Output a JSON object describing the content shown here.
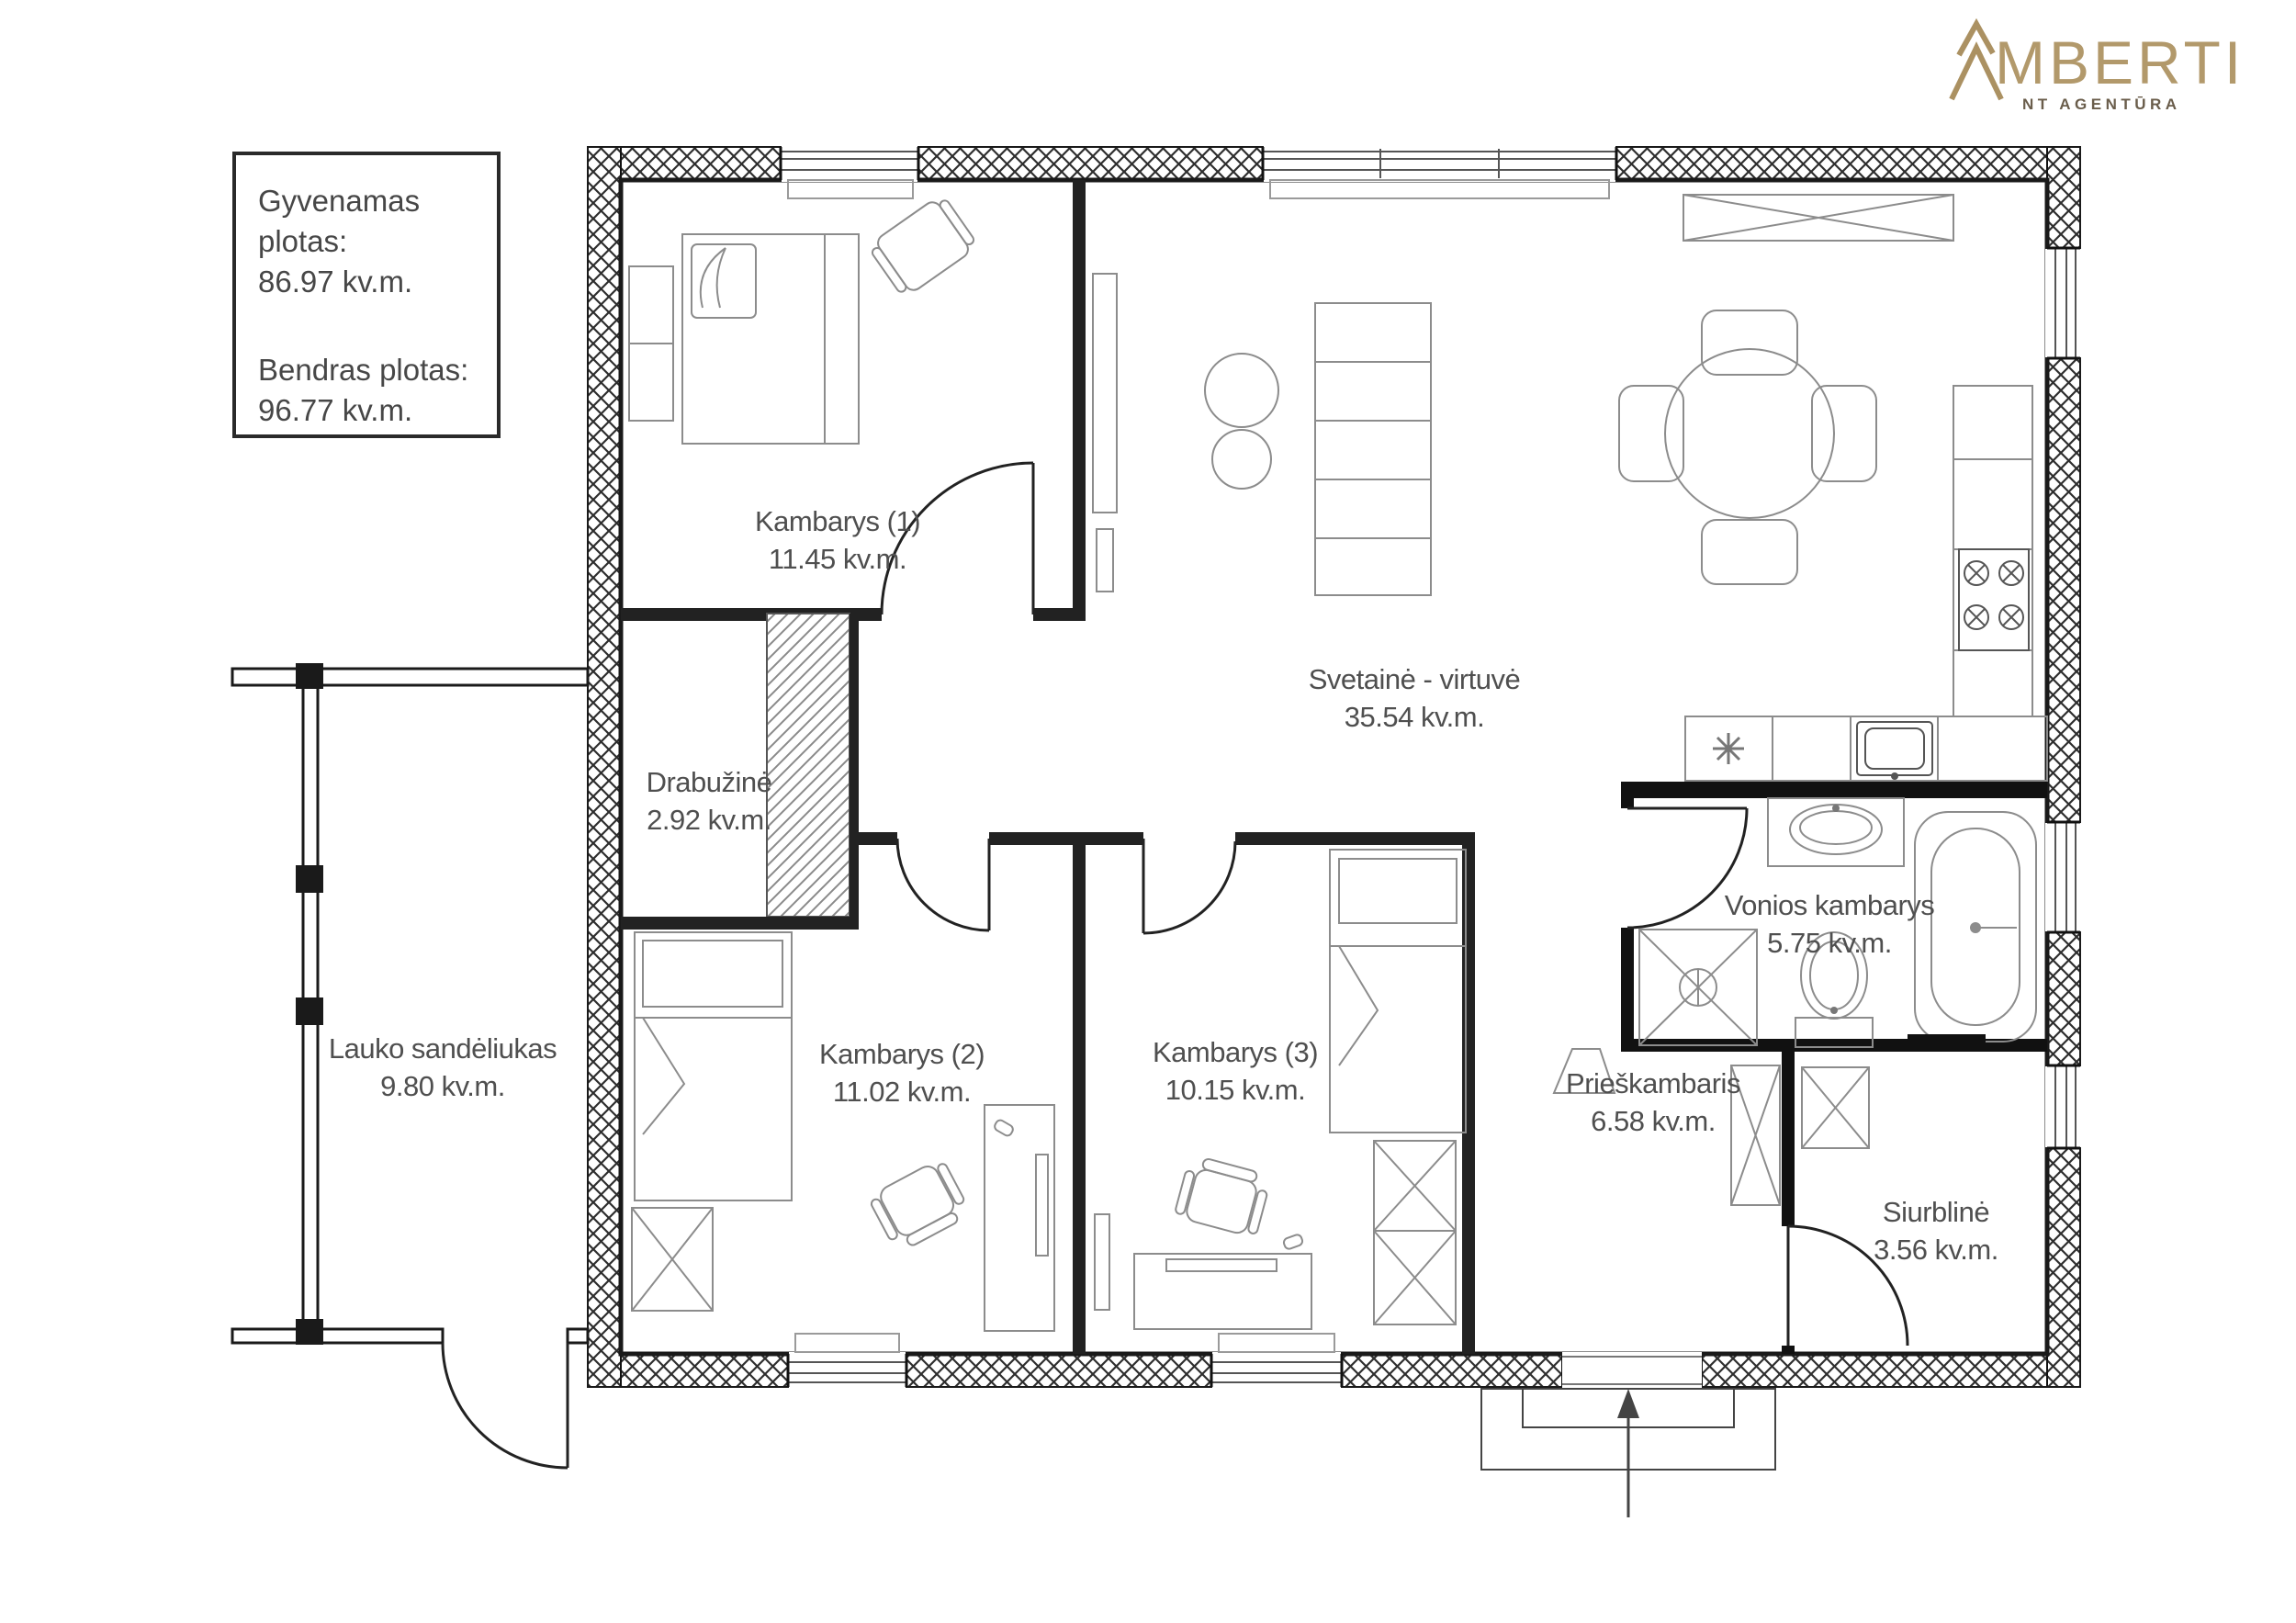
{
  "logo": {
    "name": "AMBERTI",
    "tagline": "NT AGENTŪRA"
  },
  "info_box": {
    "line1_label": "Gyvenamas plotas:",
    "line1_value": "86.97 kv.m.",
    "line2_label": "Bendras plotas:",
    "line2_value": "96.77 kv.m."
  },
  "rooms": [
    {
      "name": "Kambarys (1)",
      "area": "11.45 kv.m."
    },
    {
      "name": "Svetainė - virtuvė",
      "area": "35.54 kv.m."
    },
    {
      "name": "Drabužinė",
      "area": "2.92 kv.m."
    },
    {
      "name": "Lauko sandėliukas",
      "area": "9.80 kv.m."
    },
    {
      "name": "Kambarys (2)",
      "area": "11.02 kv.m."
    },
    {
      "name": "Kambarys (3)",
      "area": "10.15 kv.m."
    },
    {
      "name": "Vonios kambarys",
      "area": "5.75 kv.m."
    },
    {
      "name": "Prieškambaris",
      "area": "6.58 kv.m."
    },
    {
      "name": "Siurblinė",
      "area": "3.56 kv.m."
    }
  ],
  "symbols": {
    "entrance_arrow": "arrow-up",
    "stove_burner": "circle-with-x",
    "wardrobe": "rect-with-x",
    "kitchen_fixture": "asterisk"
  },
  "colors": {
    "brand_gold": "#b2996b",
    "wall_line": "#222222",
    "label_gray": "#4f4f4f"
  }
}
